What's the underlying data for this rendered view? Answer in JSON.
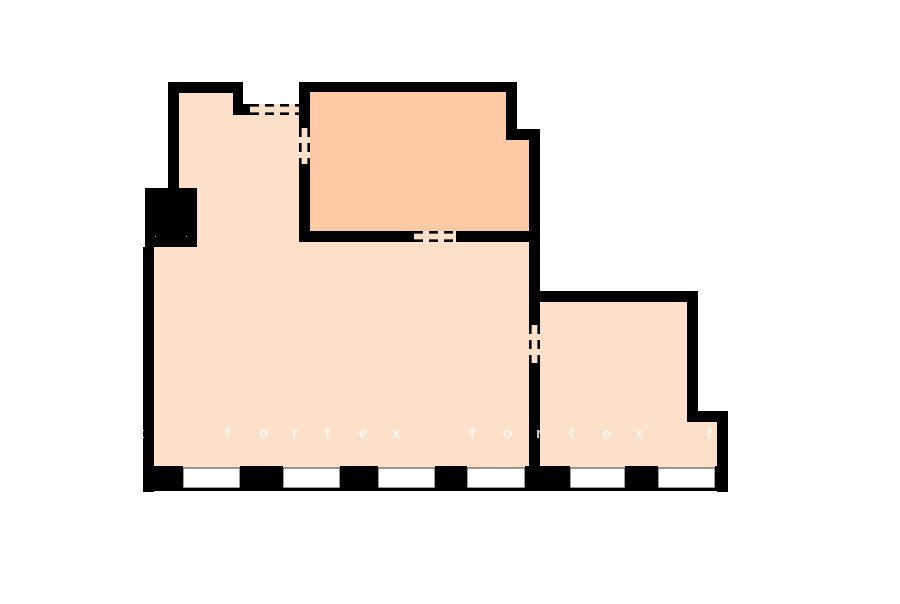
{
  "page": {
    "type": "floor-plan",
    "background": "#ffffff"
  },
  "colors": {
    "wall": "#000000",
    "floor_main": "#fce0ca",
    "floor_accent": "#fccaa4",
    "window": "#ffffff",
    "outline": "#3c3c3c",
    "watermark": "#ffffff"
  },
  "watermark": {
    "text": "fortex",
    "partial_left": "x",
    "partial_right": "f"
  },
  "rooms": {
    "main_room": {
      "fill": "#fce0ca"
    },
    "upper_room": {
      "fill": "#fccaa4"
    },
    "right_room": {
      "fill": "#fce0ca"
    }
  }
}
